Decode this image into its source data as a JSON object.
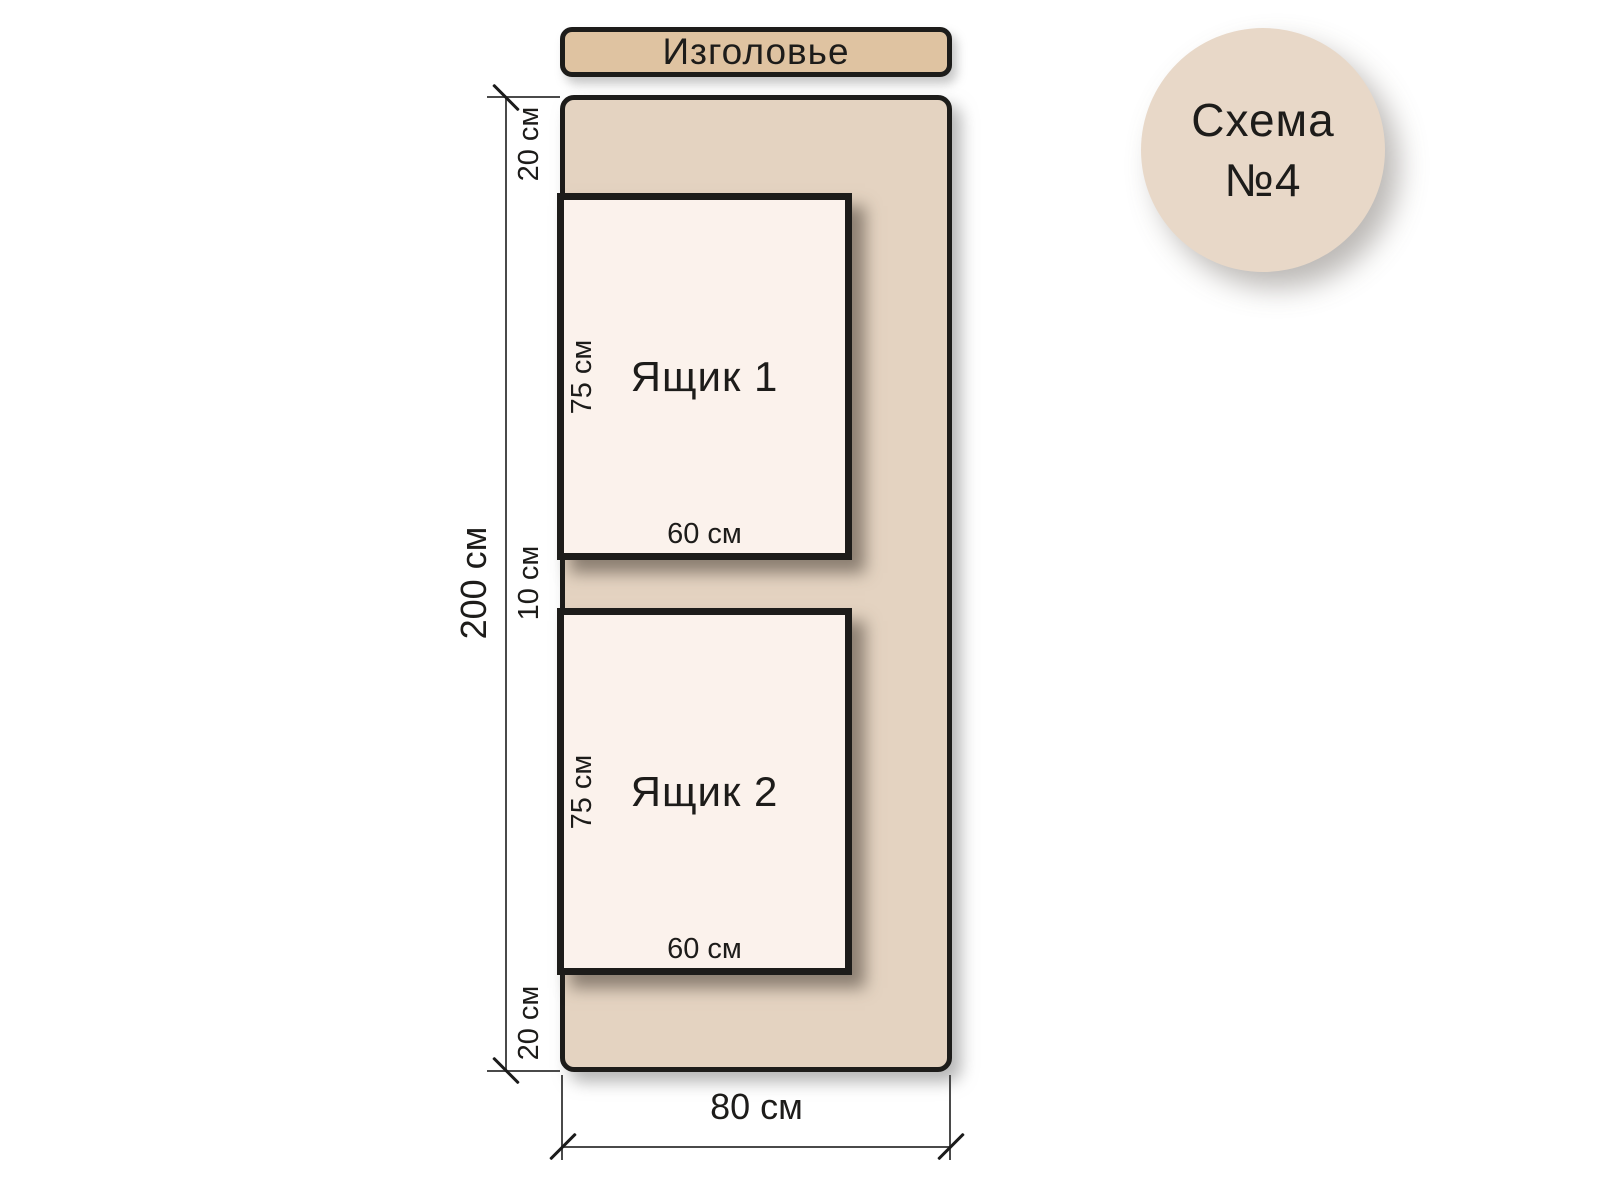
{
  "badge": {
    "line1": "Схема",
    "line2": "№4"
  },
  "headboard_label": "Изголовье",
  "dimensions": {
    "total_height": "200 см",
    "total_width": "80 см",
    "top_margin": "20 см",
    "gap": "10 см",
    "bottom_margin": "20 см"
  },
  "drawers": [
    {
      "label": "Ящик 1",
      "height": "75 см",
      "width": "60 см"
    },
    {
      "label": "Ящик 2",
      "height": "75 см",
      "width": "60 см"
    }
  ],
  "colors": {
    "headboard_fill": "#dfc3a1",
    "bed_fill": "#e4d3c1",
    "drawer_fill": "#fbf2ec",
    "badge_fill": "#e8d8c8",
    "outline": "#1d1c1a",
    "dimension_line": "#4a4a4a",
    "background": "#ffffff"
  }
}
